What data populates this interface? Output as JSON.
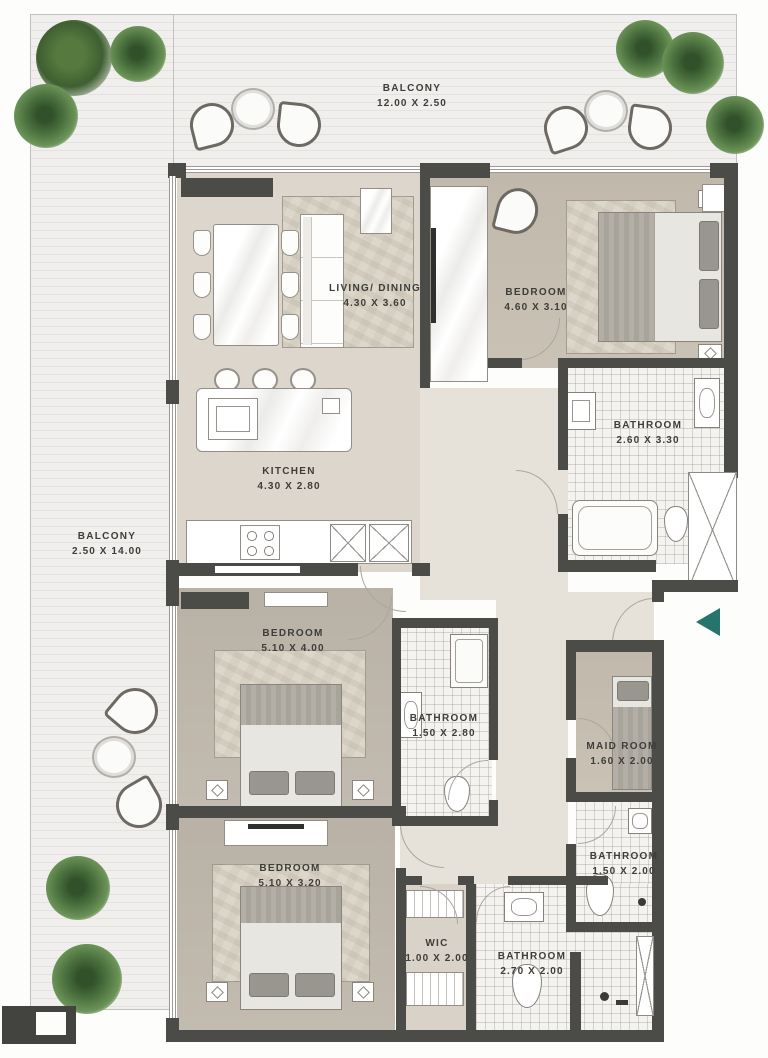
{
  "plan": {
    "kind": "apartment-floor-plan",
    "colors": {
      "wall": "#4b4b48",
      "floor_beige": "#dcd6cc",
      "floor_taupe": "#c7beb1",
      "balcony_tile": "#eeedeb",
      "entry_arrow": "#26756d",
      "plant_green": "#4d7340"
    }
  },
  "entry": {
    "marker": "entry-arrow-left",
    "color": "#26756d"
  },
  "rooms": [
    {
      "id": "balcony-top",
      "name": "BALCONY",
      "dims": "12.00 X 2.50"
    },
    {
      "id": "living-dining",
      "name": "LIVING/ DINING",
      "dims": "4.30 X 3.60"
    },
    {
      "id": "bedroom-1",
      "name": "BEDROOM",
      "dims": "4.60 X 3.10"
    },
    {
      "id": "bathroom-1",
      "name": "BATHROOM",
      "dims": "2.60 X 3.30"
    },
    {
      "id": "kitchen",
      "name": "KITCHEN",
      "dims": "4.30 X 2.80"
    },
    {
      "id": "balcony-left",
      "name": "BALCONY",
      "dims": "2.50 X 14.00"
    },
    {
      "id": "bedroom-2",
      "name": "BEDROOM",
      "dims": "5.10 X 4.00"
    },
    {
      "id": "bathroom-2",
      "name": "BATHROOM",
      "dims": "1.50 X 2.80"
    },
    {
      "id": "maid-room",
      "name": "MAID ROOM",
      "dims": "1.60 X 2.00"
    },
    {
      "id": "bedroom-3",
      "name": "BEDROOM",
      "dims": "5.10 X 3.20"
    },
    {
      "id": "bathroom-3",
      "name": "BATHROOM",
      "dims": "1.50 X 2.00"
    },
    {
      "id": "wic",
      "name": "WIC",
      "dims": "1.00 X 2.00"
    },
    {
      "id": "bathroom-4",
      "name": "BATHROOM",
      "dims": "2.70 X 2.00"
    }
  ]
}
